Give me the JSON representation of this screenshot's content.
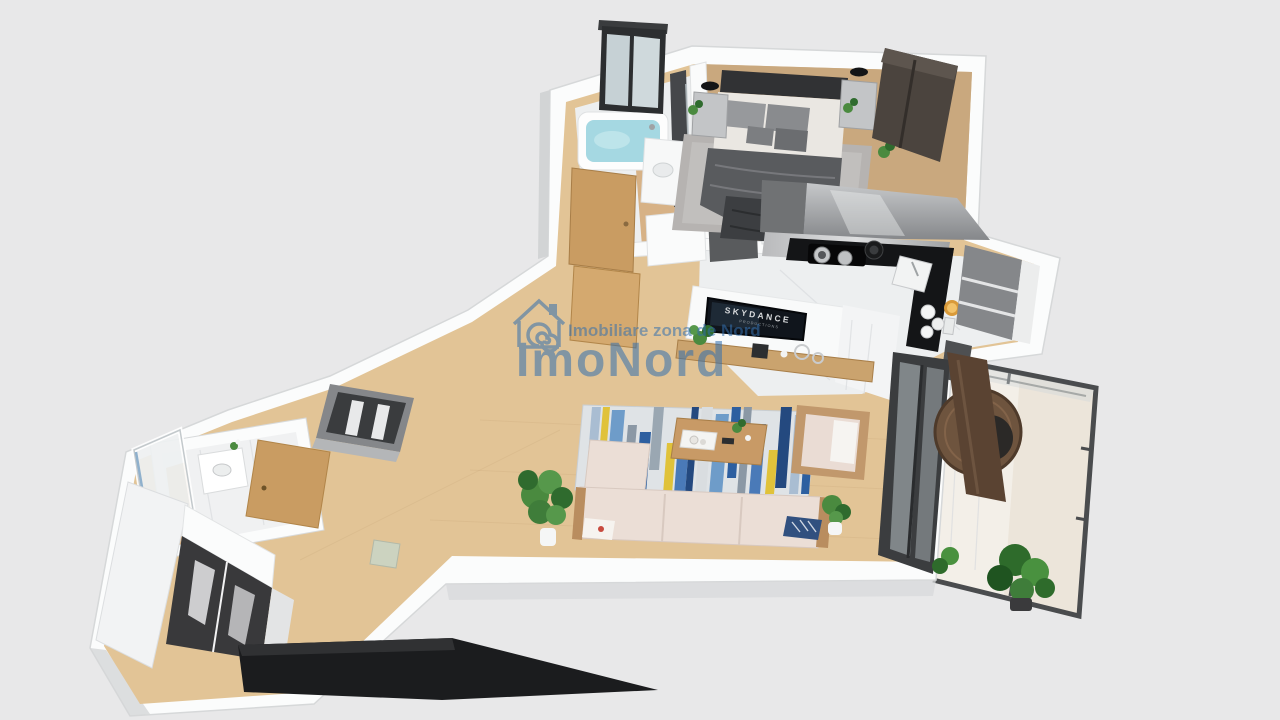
{
  "watermark": {
    "logo_icon": "house-spiral-icon",
    "tagline": "Imobiliare zona de Nord",
    "brand": "ImoNord",
    "color": "#336fae"
  },
  "tv_screen": {
    "title": "SKYDANCE",
    "subtitle": "PRODUCTIONS"
  },
  "palette": {
    "background": "#e8e8e9",
    "wall_white": "#fbfcfc",
    "wall_shade": "#d5d7d8",
    "wood_floor_bedroom": "#c9a87e",
    "wood_floor_living": "#e2c496",
    "marble_floor": "#edeff0",
    "balcony_floor": "#ece5da",
    "counter_black": "#141517",
    "cabinet_gray": "#aaacae",
    "wardrobe_brown": "#4b443e",
    "oak_door": "#c99c62",
    "headboard_dark": "#313234",
    "blanket_gray": "#595b5e",
    "rug_gray": "#b6b3b1",
    "sofa_cream": "#ebded6",
    "coffee_table_wood": "#c89a66",
    "rug_base": "#dfe3e6",
    "water_cyan": "#a5d8e2",
    "plant_green": "#4a8a3f",
    "rattan_brown": "#6e543e",
    "window_frame_dark": "#3b3d3f",
    "bench_black": "#1b1c1e"
  }
}
